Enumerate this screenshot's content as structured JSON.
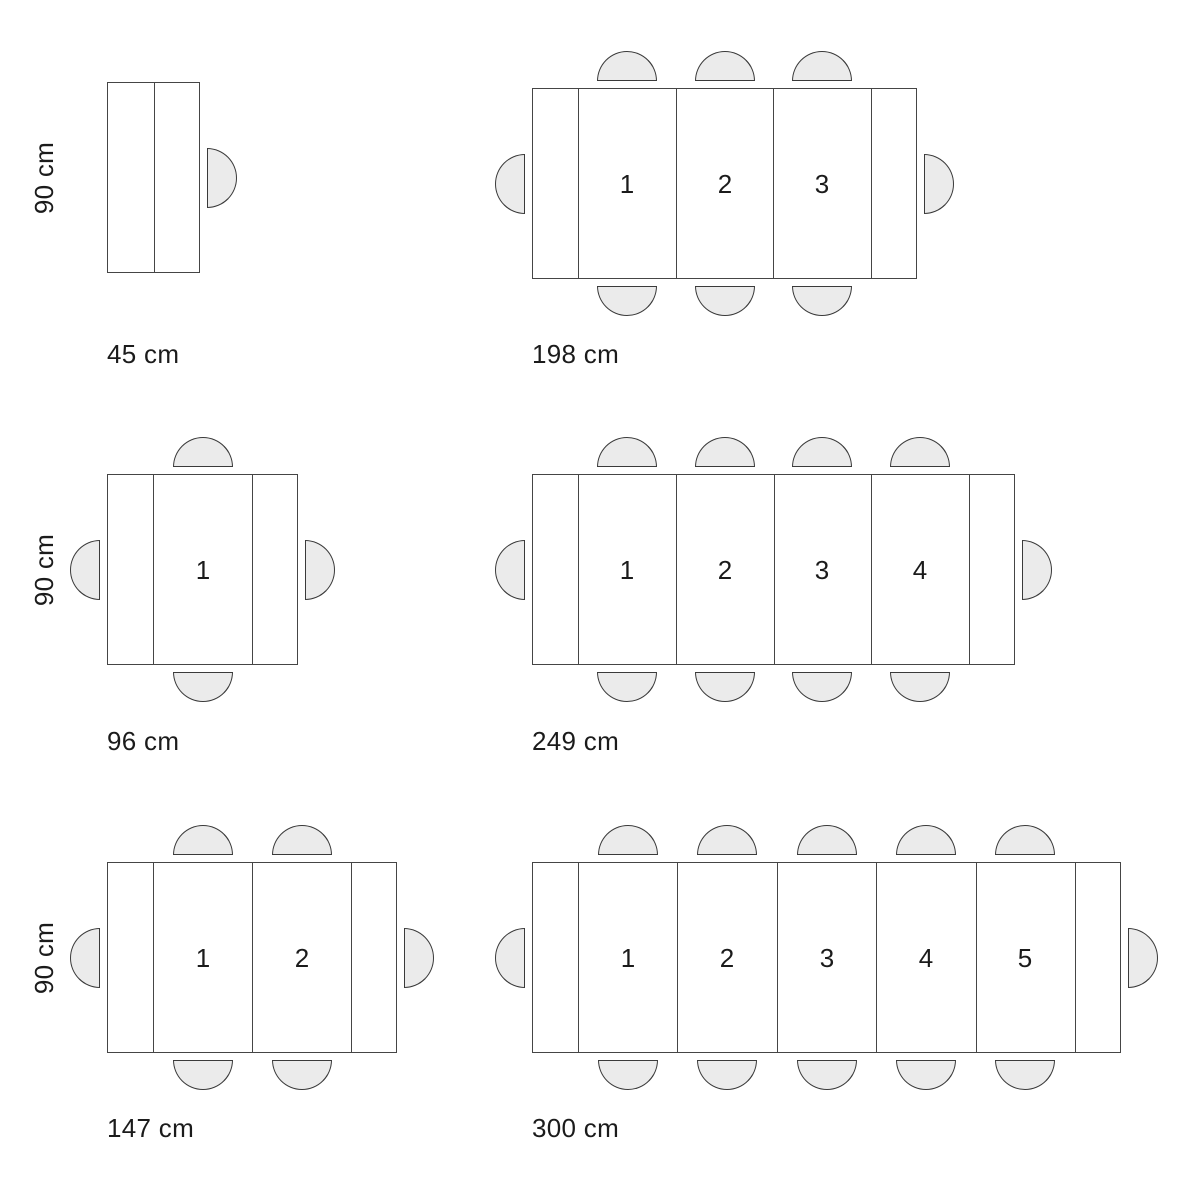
{
  "diagram": {
    "height_label": "90 cm",
    "colors": {
      "background": "#ffffff",
      "line": "#454545",
      "chair_fill": "#ebebeb",
      "chair_line": "#3a3a3a",
      "text": "#1b1b1b"
    },
    "tables": [
      {
        "key": "45",
        "name": "console-table-45cm",
        "width_label": "45 cm",
        "width_cm": 45,
        "depth_cm": 90,
        "leaf_numbers": [],
        "chairs": {
          "top": 0,
          "bottom": 0,
          "left": 0,
          "right": 1
        },
        "show_height_label": true
      },
      {
        "key": "198",
        "name": "table-198cm",
        "width_label": "198 cm",
        "width_cm": 198,
        "depth_cm": 90,
        "leaf_numbers": [
          "1",
          "2",
          "3"
        ],
        "chairs": {
          "top": 3,
          "bottom": 3,
          "left": 1,
          "right": 1
        },
        "show_height_label": false
      },
      {
        "key": "96",
        "name": "table-96cm",
        "width_label": "96 cm",
        "width_cm": 96,
        "depth_cm": 90,
        "leaf_numbers": [
          "1"
        ],
        "chairs": {
          "top": 1,
          "bottom": 1,
          "left": 1,
          "right": 1
        },
        "show_height_label": true
      },
      {
        "key": "249",
        "name": "table-249cm",
        "width_label": "249 cm",
        "width_cm": 249,
        "depth_cm": 90,
        "leaf_numbers": [
          "1",
          "2",
          "3",
          "4"
        ],
        "chairs": {
          "top": 4,
          "bottom": 4,
          "left": 1,
          "right": 1
        },
        "show_height_label": false
      },
      {
        "key": "147",
        "name": "table-147cm",
        "width_label": "147 cm",
        "width_cm": 147,
        "depth_cm": 90,
        "leaf_numbers": [
          "1",
          "2"
        ],
        "chairs": {
          "top": 2,
          "bottom": 2,
          "left": 1,
          "right": 1
        },
        "show_height_label": true
      },
      {
        "key": "300",
        "name": "table-300cm",
        "width_label": "300 cm",
        "width_cm": 300,
        "depth_cm": 90,
        "leaf_numbers": [
          "1",
          "2",
          "3",
          "4",
          "5"
        ],
        "chairs": {
          "top": 5,
          "bottom": 5,
          "left": 1,
          "right": 1
        },
        "show_height_label": false
      }
    ]
  }
}
